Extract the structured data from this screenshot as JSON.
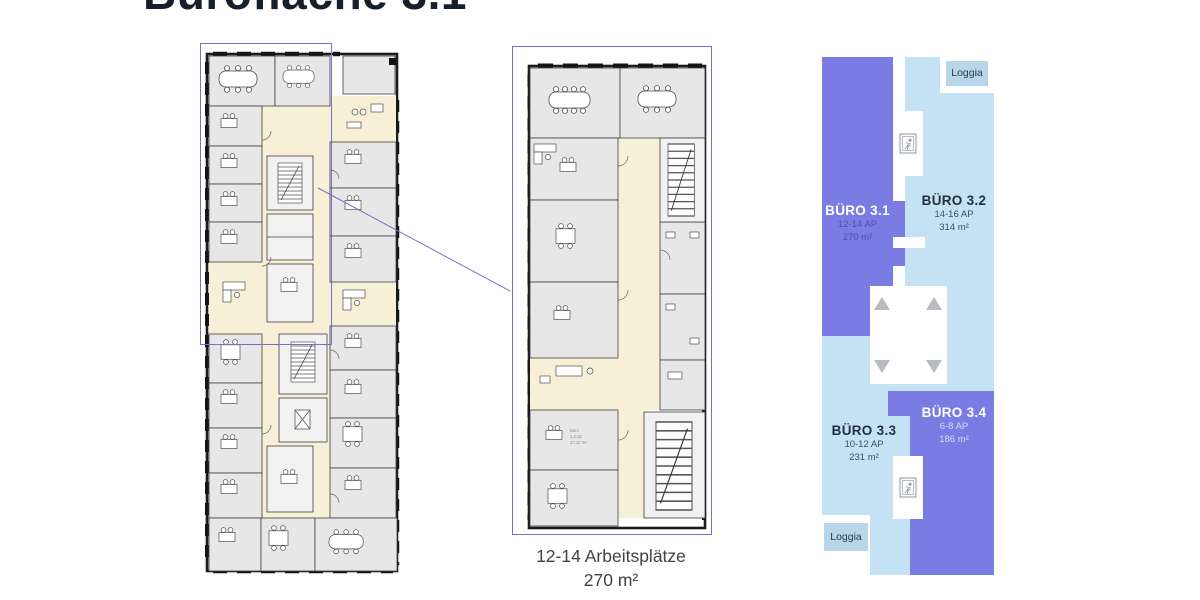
{
  "title": "Bürofläche 3.1",
  "caption": {
    "workplaces": "12-14 Arbeitsplätze",
    "area": "270 m²"
  },
  "schematic": {
    "loggia_top": "Loggia",
    "loggia_bottom": "Loggia",
    "units": [
      {
        "name": "BÜRO 3.1",
        "ap": "12-14 AP",
        "area": "270 m²"
      },
      {
        "name": "BÜRO 3.2",
        "ap": "14-16 AP",
        "area": "314 m²"
      },
      {
        "name": "BÜRO 3.3",
        "ap": "10-12 AP",
        "area": "231 m²"
      },
      {
        "name": "BÜRO 3.4",
        "ap": "6-8 AP",
        "area": "186 m²"
      }
    ]
  },
  "plan_labels": {
    "room_type": "Büro",
    "room_no": "1.2.15",
    "room_area": "27.12 m²"
  },
  "colors": {
    "purple": "#7b7ce3",
    "light_blue": "#c5e2f4",
    "loggia_blue": "#b7d6e9",
    "accent_line": "#7173cb",
    "icon_gray": "#97a0a8",
    "triangle_gray": "#b6bcc2"
  }
}
